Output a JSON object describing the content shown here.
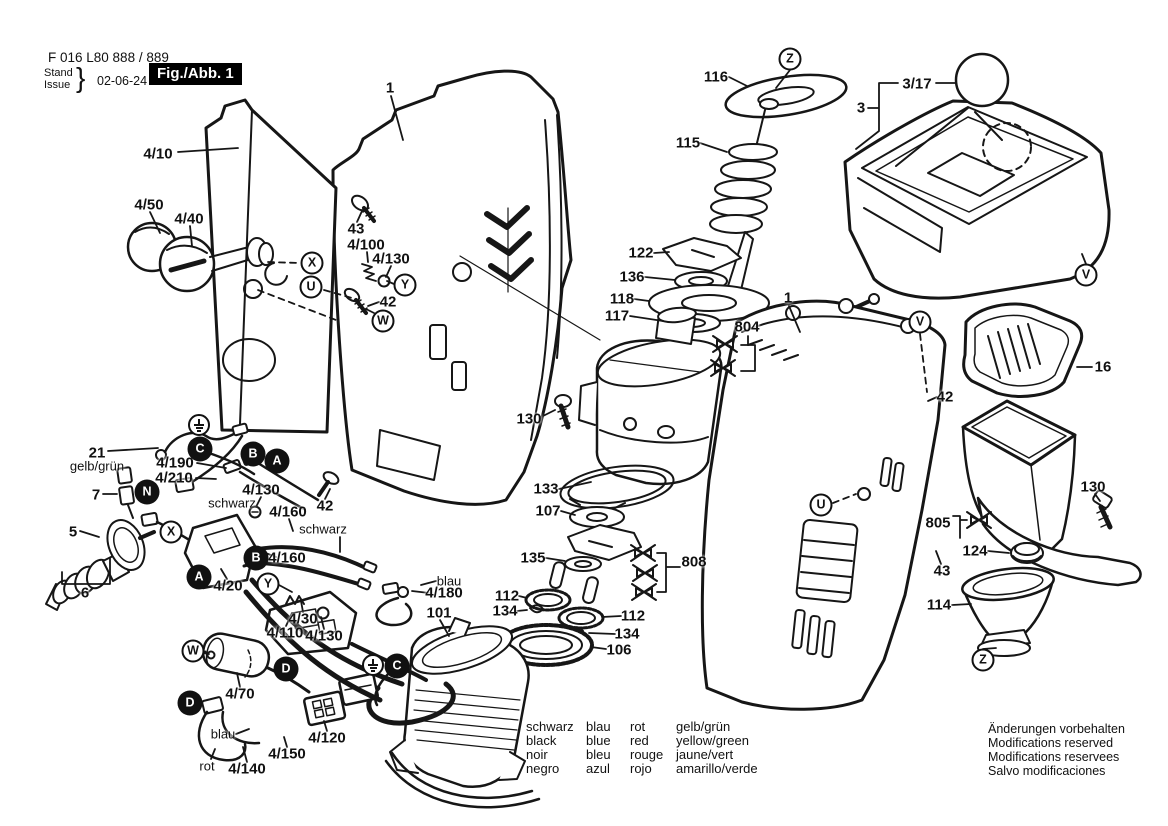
{
  "header": {
    "part_number": "F 016 L80 888 / 889",
    "stand_label": "Stand",
    "issue_label": "Issue",
    "brace": "}",
    "date": "02-06-24",
    "figure_label": "Fig./Abb. 1"
  },
  "legend": {
    "rows": [
      [
        "schwarz",
        "blau",
        "rot",
        "gelb/grün"
      ],
      [
        "black",
        "blue",
        "red",
        "yellow/green"
      ],
      [
        "noir",
        "bleu",
        "rouge",
        "jaune/vert"
      ],
      [
        "negro",
        "azul",
        "rojo",
        "amarillo/verde"
      ]
    ]
  },
  "footer_notes": [
    "Änderungen vorbehalten",
    "Modifications reserved",
    "Modifications reservees",
    "Salvo modificaciones"
  ],
  "colors": {
    "ink": "#161616",
    "background": "#ffffff",
    "figure_box_bg": "#000000",
    "figure_box_text": "#ffffff"
  },
  "part_labels": [
    {
      "text": "4/10",
      "x": 158,
      "y": 154
    },
    {
      "text": "4/50",
      "x": 149,
      "y": 205
    },
    {
      "text": "4/40",
      "x": 189,
      "y": 219
    },
    {
      "text": "1",
      "x": 390,
      "y": 88
    },
    {
      "text": "43",
      "x": 356,
      "y": 229
    },
    {
      "text": "4/100",
      "x": 366,
      "y": 245
    },
    {
      "text": "4/130",
      "x": 391,
      "y": 259
    },
    {
      "text": "42",
      "x": 388,
      "y": 302
    },
    {
      "text": "116",
      "x": 716,
      "y": 77
    },
    {
      "text": "115",
      "x": 688,
      "y": 143
    },
    {
      "text": "122",
      "x": 641,
      "y": 253
    },
    {
      "text": "136",
      "x": 632,
      "y": 277
    },
    {
      "text": "118",
      "x": 622,
      "y": 299
    },
    {
      "text": "117",
      "x": 617,
      "y": 316
    },
    {
      "text": "804",
      "x": 747,
      "y": 327
    },
    {
      "text": "1",
      "x": 788,
      "y": 298
    },
    {
      "text": "3/17",
      "x": 917,
      "y": 84
    },
    {
      "text": "3",
      "x": 861,
      "y": 108
    },
    {
      "text": "16",
      "x": 1103,
      "y": 367
    },
    {
      "text": "42",
      "x": 945,
      "y": 397
    },
    {
      "text": "130",
      "x": 529,
      "y": 419
    },
    {
      "text": "133",
      "x": 546,
      "y": 489
    },
    {
      "text": "107",
      "x": 548,
      "y": 511
    },
    {
      "text": "135",
      "x": 533,
      "y": 558
    },
    {
      "text": "808",
      "x": 694,
      "y": 562
    },
    {
      "text": "112",
      "x": 507,
      "y": 596
    },
    {
      "text": "134",
      "x": 505,
      "y": 611
    },
    {
      "text": "112",
      "x": 633,
      "y": 616
    },
    {
      "text": "134",
      "x": 627,
      "y": 634
    },
    {
      "text": "106",
      "x": 619,
      "y": 650
    },
    {
      "text": "101",
      "x": 439,
      "y": 613
    },
    {
      "text": "4/180",
      "x": 444,
      "y": 593
    },
    {
      "text": "21",
      "x": 97,
      "y": 453
    },
    {
      "text": "4/190",
      "x": 175,
      "y": 463
    },
    {
      "text": "4/210",
      "x": 174,
      "y": 478
    },
    {
      "text": "7",
      "x": 96,
      "y": 495
    },
    {
      "text": "4/130",
      "x": 261,
      "y": 490
    },
    {
      "text": "42",
      "x": 325,
      "y": 506
    },
    {
      "text": "4/160",
      "x": 288,
      "y": 512
    },
    {
      "text": "5",
      "x": 73,
      "y": 532
    },
    {
      "text": "4/160",
      "x": 287,
      "y": 558
    },
    {
      "text": "4/20",
      "x": 228,
      "y": 586
    },
    {
      "text": "6",
      "x": 85,
      "y": 593
    },
    {
      "text": "4/30",
      "x": 303,
      "y": 619
    },
    {
      "text": "4/110",
      "x": 285,
      "y": 633
    },
    {
      "text": "4/130",
      "x": 324,
      "y": 636
    },
    {
      "text": "4/70",
      "x": 240,
      "y": 694
    },
    {
      "text": "4/120",
      "x": 327,
      "y": 738
    },
    {
      "text": "4/150",
      "x": 287,
      "y": 754
    },
    {
      "text": "4/140",
      "x": 247,
      "y": 769
    },
    {
      "text": "805",
      "x": 938,
      "y": 523
    },
    {
      "text": "124",
      "x": 975,
      "y": 551
    },
    {
      "text": "43",
      "x": 942,
      "y": 571
    },
    {
      "text": "114",
      "x": 939,
      "y": 605
    },
    {
      "text": "130",
      "x": 1093,
      "y": 487
    },
    {
      "text": "gelb/grün",
      "x": 97,
      "y": 466,
      "small": true
    },
    {
      "text": "schwarz",
      "x": 232,
      "y": 503,
      "small": true
    },
    {
      "text": "schwarz",
      "x": 323,
      "y": 529,
      "small": true
    },
    {
      "text": "blau",
      "x": 449,
      "y": 581,
      "small": true
    },
    {
      "text": "blau",
      "x": 223,
      "y": 734,
      "small": true
    },
    {
      "text": "rot",
      "x": 207,
      "y": 766,
      "small": true
    }
  ],
  "ref_markers": [
    {
      "type": "outline",
      "letter": "X",
      "x": 312,
      "y": 263
    },
    {
      "type": "outline",
      "letter": "U",
      "x": 311,
      "y": 287
    },
    {
      "type": "outline",
      "letter": "Y",
      "x": 405,
      "y": 285
    },
    {
      "type": "outline",
      "letter": "W",
      "x": 383,
      "y": 321
    },
    {
      "type": "outline",
      "letter": "Z",
      "x": 790,
      "y": 59
    },
    {
      "type": "outline",
      "letter": "V",
      "x": 1086,
      "y": 275
    },
    {
      "type": "outline",
      "letter": "V",
      "x": 920,
      "y": 322
    },
    {
      "type": "outline",
      "letter": "U",
      "x": 821,
      "y": 505
    },
    {
      "type": "outline",
      "letter": "Z",
      "x": 983,
      "y": 660
    },
    {
      "type": "outline",
      "letter": "X",
      "x": 171,
      "y": 532
    },
    {
      "type": "outline",
      "letter": "Y",
      "x": 268,
      "y": 584
    },
    {
      "type": "outline",
      "letter": "W",
      "x": 193,
      "y": 651
    },
    {
      "type": "filled",
      "letter": "C",
      "x": 200,
      "y": 449
    },
    {
      "type": "filled",
      "letter": "B",
      "x": 253,
      "y": 454
    },
    {
      "type": "filled",
      "letter": "A",
      "x": 277,
      "y": 461
    },
    {
      "type": "filled",
      "letter": "N",
      "x": 147,
      "y": 492
    },
    {
      "type": "filled",
      "letter": "B",
      "x": 256,
      "y": 558
    },
    {
      "type": "filled",
      "letter": "A",
      "x": 199,
      "y": 577
    },
    {
      "type": "filled",
      "letter": "D",
      "x": 286,
      "y": 669
    },
    {
      "type": "filled",
      "letter": "D",
      "x": 190,
      "y": 703
    },
    {
      "type": "filled",
      "letter": "C",
      "x": 397,
      "y": 666
    },
    {
      "type": "ground",
      "x": 199,
      "y": 425
    },
    {
      "type": "ground",
      "x": 373,
      "y": 665
    }
  ]
}
